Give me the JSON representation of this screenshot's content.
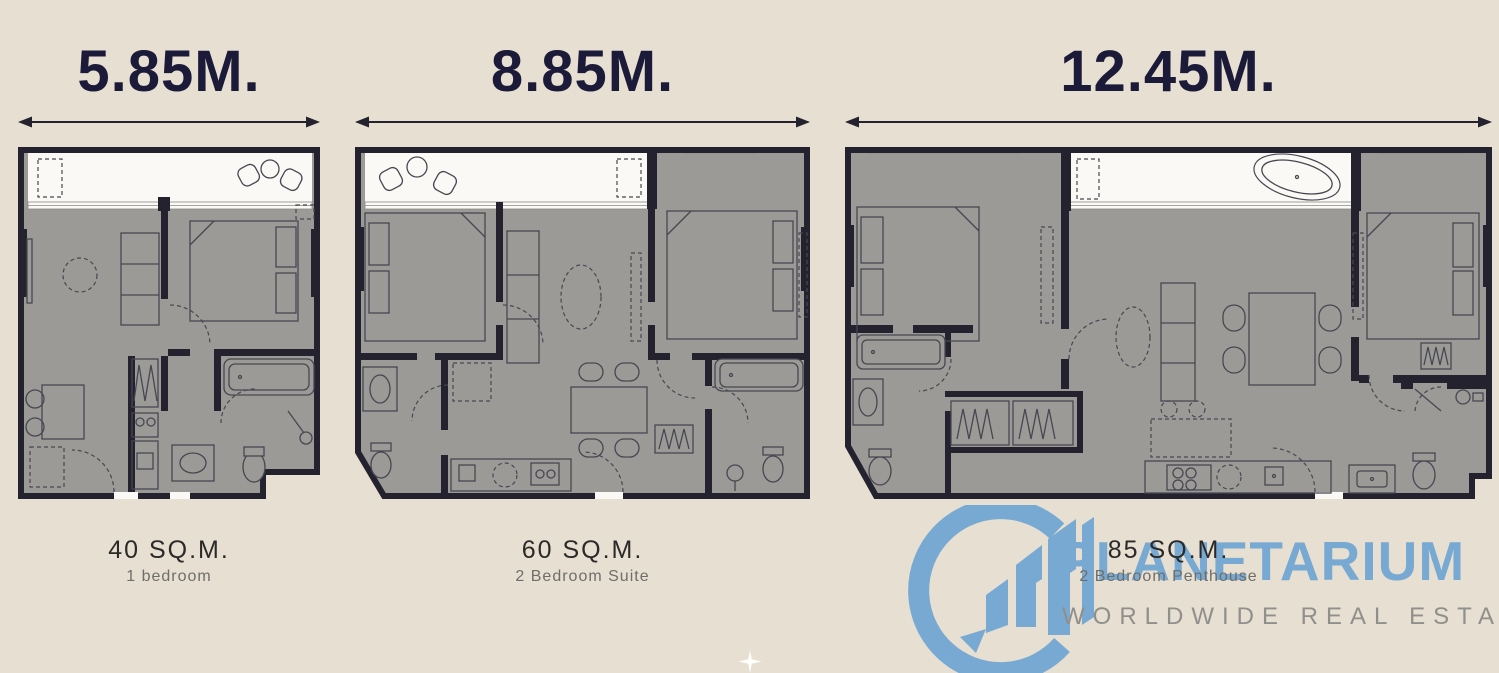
{
  "page": {
    "background_color": "#e6dfd2"
  },
  "colors": {
    "wall": "#23222e",
    "floor_fill": "#9b9a96",
    "balcony_fill": "#fbf9f5",
    "dimension_text": "#1b1a38",
    "caption_text": "#2b2a28",
    "subcaption_text": "#6f6e69",
    "logo_blue": "#77a9d2",
    "tagline_gray": "#8f8f8b"
  },
  "units": [
    {
      "width_label": "5.85M.",
      "area_label": "40 SQ.M.",
      "type_label": "1 bedroom"
    },
    {
      "width_label": "8.85M.",
      "area_label": "60 SQ.M.",
      "type_label": "2 Bedroom Suite"
    },
    {
      "width_label": "12.45M.",
      "area_label": "85 SQ.M.",
      "type_label": "2 Bedroom Penthouse"
    }
  ],
  "watermark": {
    "brand": "PLANETARIUM",
    "tagline": "WORLDWIDE REAL ESTATE"
  }
}
